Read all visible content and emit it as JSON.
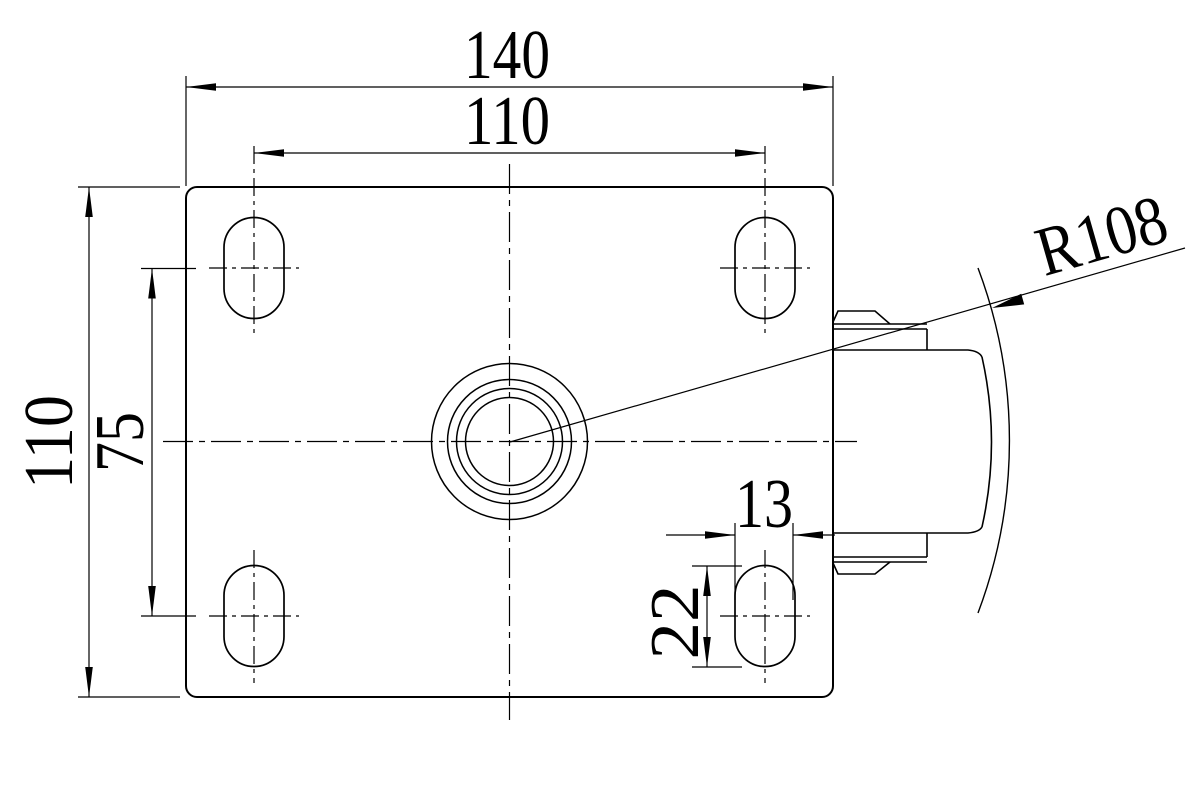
{
  "drawing": {
    "background_color": "#ffffff",
    "line_color": "#000000",
    "view": "caster-top-plate-top-view",
    "dimensions": {
      "plate_width": "140",
      "hole_spacing_horizontal": "110",
      "plate_height": "110",
      "hole_spacing_vertical": "75",
      "slot_width": "13",
      "slot_length": "22",
      "wheel_radius": "R108"
    }
  }
}
